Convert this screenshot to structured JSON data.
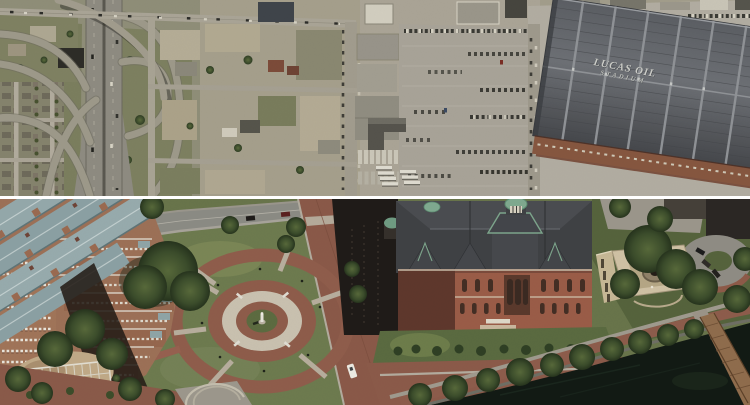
{
  "photos": {
    "top": {
      "description": "vertical satellite view: freeway interchange at left, vacant industrial blocks, large parking lots and Lucas Oil Stadium at right",
      "stadium_roof_text": {
        "line1": "LUCAS OIL",
        "line2": "STADIUM"
      }
    },
    "bottom": {
      "description": "oblique aerial view: brick condominium tower, circular monument plaza, Victorian pumping-station building with copper cupolas, brick chimney, sculpture garden, tree-lined harbor promenade, dark water and wooden pier"
    },
    "divider_color": "#ffffff"
  },
  "palette": {
    "top_ground": "#a29d8b",
    "top_green": "#7b7e5e",
    "road_gray": "#a9a496",
    "stadium_roof_dark": "#53565a",
    "stadium_roof_ridge": "#8f9296",
    "stadium_brick": "#7b5140",
    "roof_text_color": "#cbccc7",
    "bottom_lawn": "#6d7a4e",
    "brick_paving": "#8b5a49",
    "plaza_stone": "#c9c1b0",
    "tree_green": "#35452a",
    "condo_roof_slate": "#93a7a9",
    "condo_brick": "#9c7057",
    "museum_brick": "#9a5c47",
    "museum_roof": "#3f4144",
    "copper_green": "#7fa98f",
    "water": "#121a14",
    "pier_wood": "#8f6c4c",
    "shadow_dark": "#241c17"
  }
}
